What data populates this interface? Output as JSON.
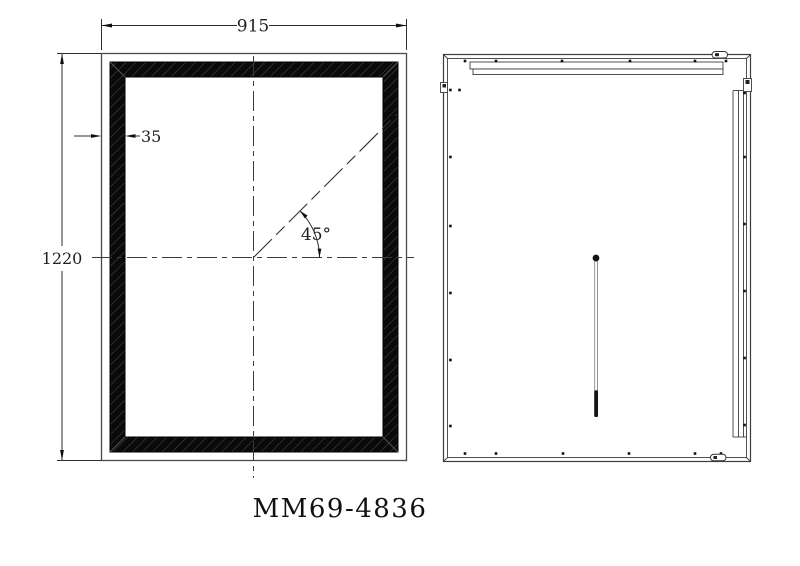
{
  "drawing": {
    "model_number": "MM69-4836",
    "front_view": {
      "width_dim_label": "915",
      "height_dim_label": "1220",
      "frame_width_dim_label": "35",
      "angle_dim_label": "45°"
    }
  },
  "colors": {
    "line": "#2d2d2d",
    "frame_fill": "#0a0a0a",
    "background": "#ffffff"
  }
}
